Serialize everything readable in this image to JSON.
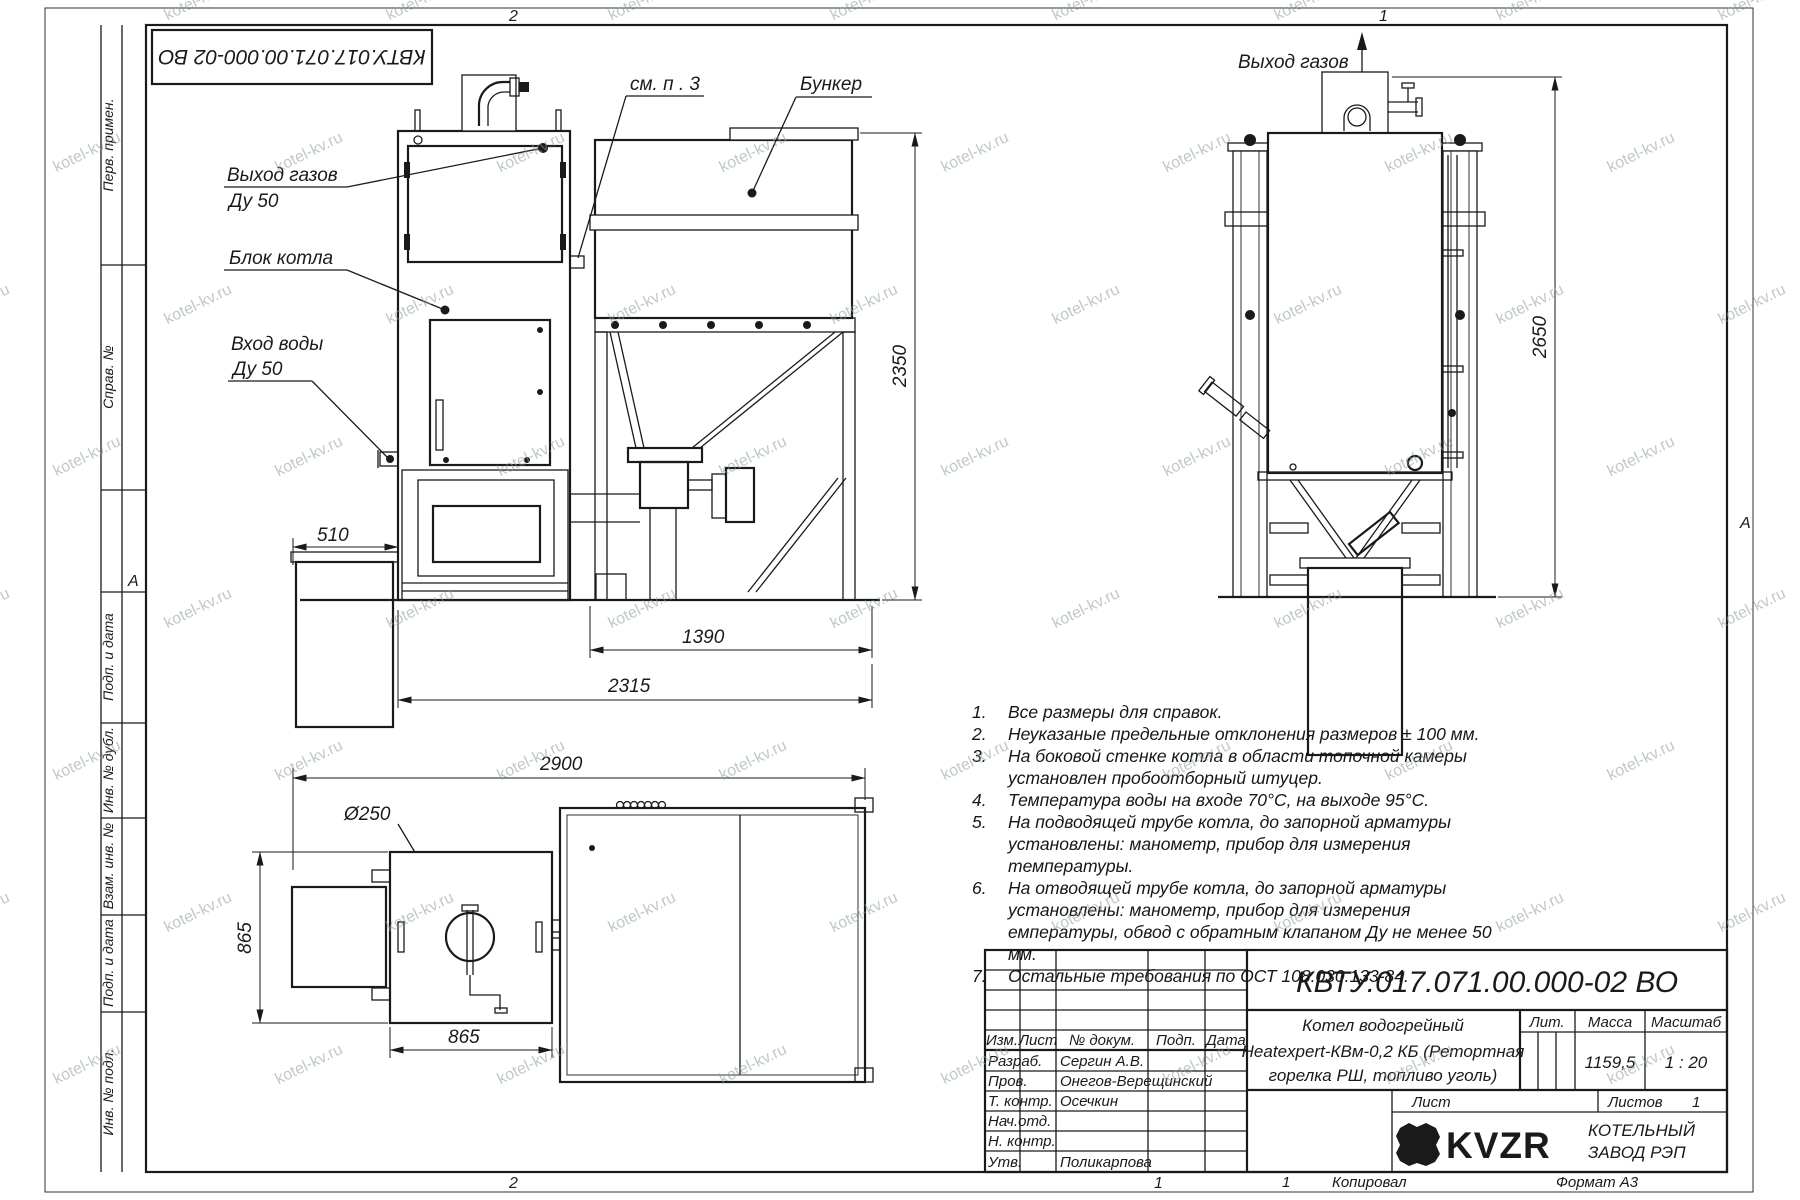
{
  "watermark": "kotel-kv.ru",
  "frame": {
    "doc_number_inverted": "КВТУ.017.071.00.000-02 ВО",
    "zone_top_left": "2",
    "zone_top_right": "1",
    "zone_bottom_left": "2",
    "zone_bottom_right": "1",
    "marker_left": "А",
    "marker_right": "А",
    "sidebar": [
      "Перв. примен.",
      "Справ. №",
      "Подп. и дата",
      "Инв. № дубл.",
      "Взам. инв. №",
      "Подп. и дата",
      "Инв. № подл."
    ]
  },
  "views": {
    "front": {
      "label_gas_outlet_1": "Выход газов",
      "label_gas_outlet_2": "Ду 50",
      "label_boiler_block": "Блок котла",
      "label_water_inlet_1": "Вход воды",
      "label_water_inlet_2": "Ду 50",
      "label_see_note": "см. п . 3",
      "label_bunker": "Бункер",
      "dim_height": "2350",
      "dim_ashbox": "510",
      "dim_bunker": "1390",
      "dim_overall": "2315"
    },
    "side": {
      "label_gas_outlet": "Выход газов",
      "dim_height": "2650"
    },
    "plan": {
      "label_diameter": "Ø250",
      "dim_overall": "2900",
      "dim_depth": "865",
      "dim_width": "865"
    }
  },
  "notes": {
    "items": [
      {
        "n": "1.",
        "text": "Все размеры для справок."
      },
      {
        "n": "2.",
        "text": "Неуказаные предельные отклонения размеров ± 100 мм."
      },
      {
        "n": "3.",
        "text": "На боковой стенке котла в области топочной камеры установлен пробоотборный штуцер."
      },
      {
        "n": "4.",
        "text": "Температура воды на входе 70°С, на выходе 95°С."
      },
      {
        "n": "5.",
        "text": "На подводящей трубе котла, до запорной арматуры установлены: манометр, прибор для измерения температуры."
      },
      {
        "n": "6.",
        "text": "На отводящей трубе котла, до запорной арматуры установлены: манометр, прибор для измерения емпературы, обвод с обратным клапаном Ду не менее 50 мм."
      },
      {
        "n": "7.",
        "text": "Остальные требования по ОСТ 108.030.133-84."
      }
    ]
  },
  "title_block": {
    "doc_number": "КВТУ.017.071.00.000-02 ВО",
    "title_line1": "Котел водогрейный",
    "title_line2": "Heatexpert-КВм-0,2 КБ (Ретортная",
    "title_line3": "горелка РШ, топливо уголь)",
    "h_izm": "Изм.",
    "h_list": "Лист",
    "h_doc": "№ докум.",
    "h_podp": "Подп.",
    "h_data": "Дата",
    "r1_role": "Разраб.",
    "r1_name": "Сергин А.В.",
    "r2_role": "Пров.",
    "r2_name": "Онегов-Верещинский",
    "r3_role": "Т. контр.",
    "r3_name": "Осечкин",
    "r4_role": "Нач.отд.",
    "r4_name": "",
    "r5_role": "Н. контр.",
    "r5_name": "",
    "r6_role": "Утв.",
    "r6_name": "Поликарпова",
    "lit_label": "Лит.",
    "mass_label": "Масса",
    "scale_label": "Масштаб",
    "mass_value": "1159,5",
    "scale_value": "1 : 20",
    "sheet_label": "Лист",
    "sheets_label": "Листов",
    "sheets_value": "1",
    "company_logo": "KVZR",
    "company_line1": "КОТЕЛЬНЫЙ",
    "company_line2": "ЗАВОД РЭП",
    "footer_num": "1",
    "footer_copied": "Копировал",
    "footer_format": "Формат А3"
  }
}
